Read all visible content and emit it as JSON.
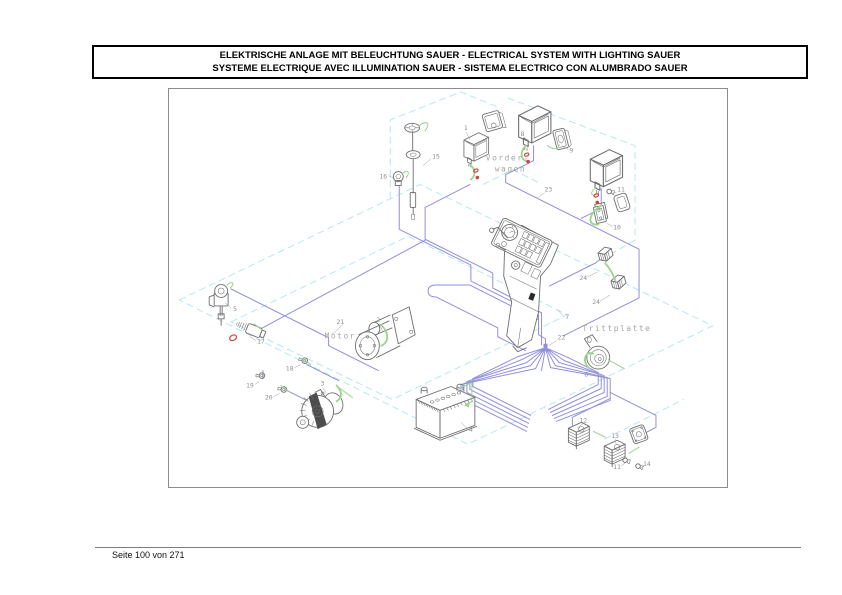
{
  "header": {
    "title_line1": "ELEKTRISCHE ANLAGE MIT BELEUCHTUNG SAUER - ELECTRICAL SYSTEM WITH LIGHTING SAUER",
    "title_line2": "SYSTEME ELECTRIQUE AVEC ILLUMINATION SAUER - SISTEMA ELECTRICO CON ALUMBRADO SAUER"
  },
  "footer": {
    "page_indicator": "Seite 100 von 271"
  },
  "diagram": {
    "area_labels": {
      "front_line1": "Vorder-",
      "front_line2": "wagen",
      "engine": "Motor",
      "footboard": "Trittplatte"
    },
    "callouts": [
      {
        "num": "1",
        "part": "front-work-lamp"
      },
      {
        "num": "15",
        "part": "fuel-level-sender"
      },
      {
        "num": "16",
        "part": "small-sensor"
      },
      {
        "num": "8",
        "part": "headlamp"
      },
      {
        "num": "9",
        "part": "lamp-housing"
      },
      {
        "num": "23",
        "part": "front-harness-wire"
      },
      {
        "num": "11",
        "part": "bulb-front"
      },
      {
        "num": "10",
        "part": "lamp-bracket"
      },
      {
        "num": "24",
        "part": "connector-upper"
      },
      {
        "num": "24",
        "part": "connector-lower"
      },
      {
        "num": "7",
        "part": "control-console"
      },
      {
        "num": "22",
        "part": "main-harness-node"
      },
      {
        "num": "21",
        "part": "engine-harness-wire"
      },
      {
        "num": "2",
        "part": "starter-motor"
      },
      {
        "num": "5",
        "part": "ignition-solenoid"
      },
      {
        "num": "17",
        "part": "temperature-sensor"
      },
      {
        "num": "18",
        "part": "switch"
      },
      {
        "num": "19",
        "part": "switch"
      },
      {
        "num": "20",
        "part": "switch"
      },
      {
        "num": "3",
        "part": "alternator"
      },
      {
        "num": "4",
        "part": "battery"
      },
      {
        "num": "6",
        "part": "horn"
      },
      {
        "num": "12",
        "part": "rear-lamp-left"
      },
      {
        "num": "13",
        "part": "rear-lamp-right"
      },
      {
        "num": "11",
        "part": "bulb-rear"
      },
      {
        "num": "14",
        "part": "bulb-small"
      }
    ],
    "colors": {
      "wire_blue": "#8f8fdc",
      "wire_green": "#9bd38b",
      "frame_dashed_cyan": "#b7e7f0",
      "marker_red": "#cc4343",
      "callout_gray": "#8f8f8f",
      "part_outline": "#6e6e6e"
    }
  }
}
